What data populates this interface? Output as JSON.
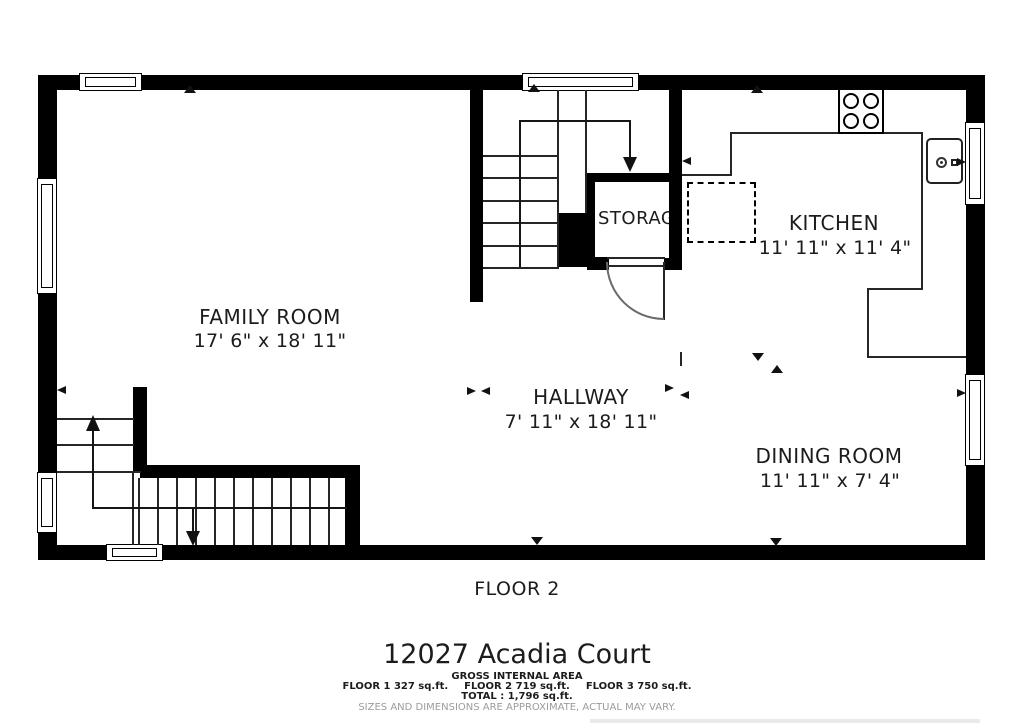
{
  "title": {
    "floor_label": "FLOOR 2",
    "address": "12027 Acadia Court"
  },
  "rooms": [
    {
      "name": "FAMILY ROOM",
      "dims": "17' 6\" x 18' 11\""
    },
    {
      "name": "KITCHEN",
      "dims": "11' 11\" x 11' 4\""
    },
    {
      "name": "HALLWAY",
      "dims": "7' 11\" x 18' 11\""
    },
    {
      "name": "DINING ROOM",
      "dims": "11' 11\" x 7' 4\""
    },
    {
      "name": "STORAGE",
      "dims": ""
    }
  ],
  "footer": {
    "gross_heading": "GROSS INTERNAL AREA",
    "areas": [
      "FLOOR 1 327 sq.ft.",
      "FLOOR 2 719 sq.ft.",
      "FLOOR 3 750 sq.ft."
    ],
    "total": "TOTAL :  1,796 sq.ft.",
    "disclaimer": "SIZES AND DIMENSIONS ARE APPROXIMATE, ACTUAL MAY VARY."
  },
  "colors": {
    "wall": "#000000",
    "line": "#262626",
    "text": "#1c1c1c",
    "muted": "#9b9b9b",
    "background": "#ffffff"
  }
}
